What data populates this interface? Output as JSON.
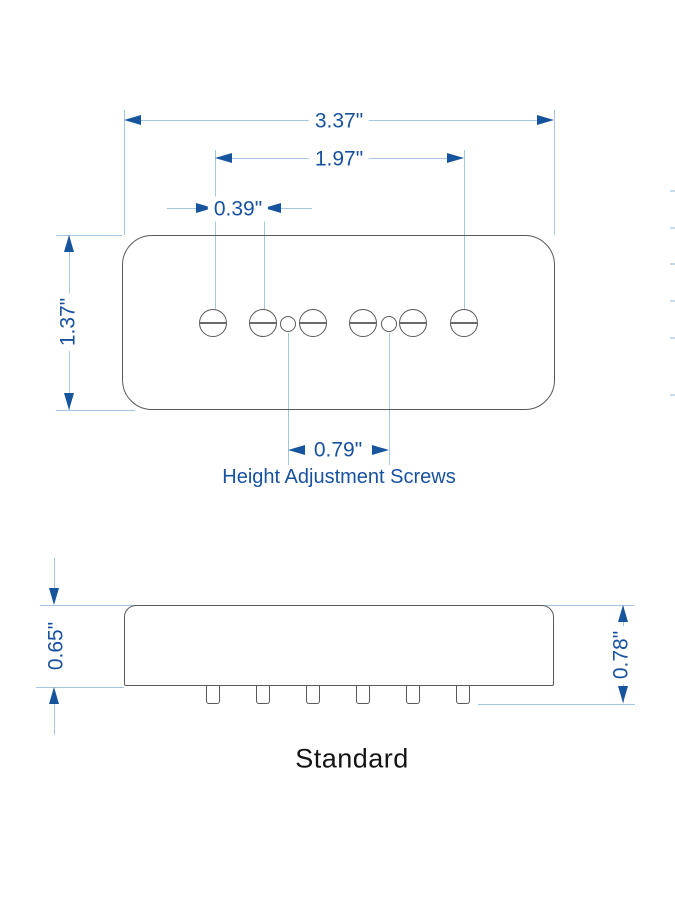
{
  "diagram": {
    "title": "Standard",
    "top_view": {
      "overall_width_label": "3.37\"",
      "pole_span_label": "1.97\"",
      "screw_pitch_label": "0.39\"",
      "body_height_label": "1.37\"",
      "adjust_screw_span_label": "0.79\"",
      "screws_caption": "Height Adjustment Screws"
    },
    "side_view": {
      "body_depth_label": "0.65\"",
      "total_depth_label": "0.78\""
    },
    "colors": {
      "accent_blue": "#16549e",
      "text_blue": "#17519f",
      "line_blue": "#a4c6e4",
      "outline_gray": "#59595b",
      "title_black": "#141414"
    }
  }
}
